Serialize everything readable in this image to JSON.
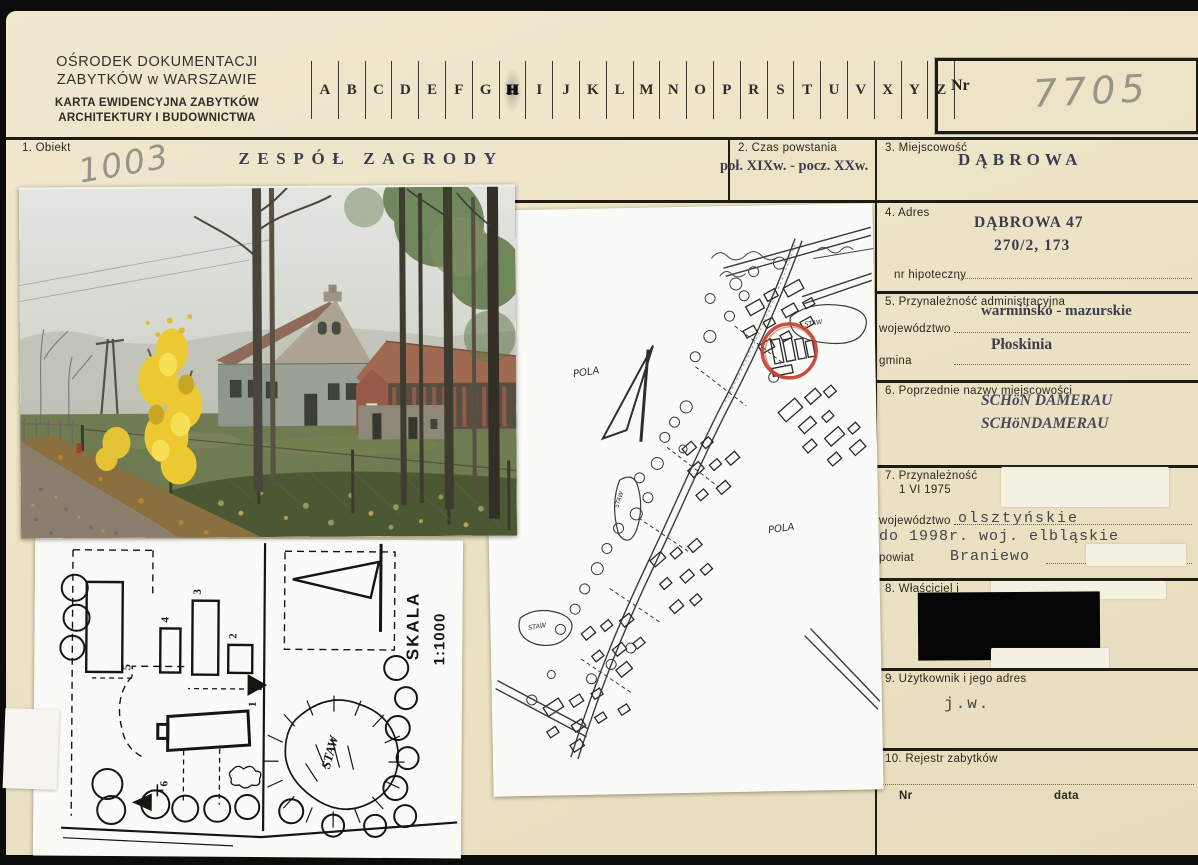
{
  "header": {
    "org_line1": "OŚRODEK DOKUMENTACJI",
    "org_line2": "ZABYTKÓW w WARSZAWIE",
    "card_type_line1": "KARTA EWIDENCYJNA ZABYTKÓW",
    "card_type_line2": "ARCHITEKTURY I BUDOWNICTWA",
    "nr_label": "Nr",
    "nr_value": "7705",
    "index_letters": [
      "A",
      "B",
      "C",
      "D",
      "E",
      "F",
      "G",
      "H",
      "I",
      "J",
      "K",
      "L",
      "M",
      "N",
      "O",
      "P",
      "R",
      "S",
      "T",
      "U",
      "V",
      "X",
      "Y",
      "Z"
    ],
    "index_marked_letter": "H"
  },
  "section1": {
    "label": "1.  Obiekt",
    "value": "ZESPÓŁ ZAGRODY",
    "inventory_number": "1003"
  },
  "section2": {
    "label": "2.  Czas powstania",
    "value": "poł. XIXw. - pocz. XXw."
  },
  "section3": {
    "label": "3.  Miejscowość",
    "value": "DĄBROWA"
  },
  "section4": {
    "label": "4.  Adres",
    "line1": "DĄBROWA 47",
    "line2": "270/2, 173",
    "field_label": "nr hipoteczny"
  },
  "section5": {
    "label": "5.  Przynależność administracyjna",
    "voivodeship_label": "województwo",
    "voivodeship_value": "warmińsko - mazurskie",
    "gmina_label": "gmina",
    "gmina_value": "Płoskinia"
  },
  "section6": {
    "label": "6.  Poprzednie nazwy miejscowości",
    "name1": "SCHöN DAMERAU",
    "name2": "SCHöNDAMERAU"
  },
  "section7": {
    "label": "7.  Przynależność",
    "date": "1 VI 1975",
    "voivodeship_label": "województwo",
    "voivodeship_value": "olsztyńskie",
    "note": "do 1998r. woj. elbląskie",
    "powiat_label": "powiat",
    "powiat_value": "Braniewo"
  },
  "section8": {
    "label": "8.  Właściciel i"
  },
  "section9": {
    "label": "9.  Użytkownik i jego adres",
    "value": "j.w."
  },
  "section10": {
    "label": "10.  Rejestr zabytków",
    "nr_label": "Nr",
    "data_label": "data"
  },
  "site_map": {
    "pola_label": "POLA",
    "staw_label": "STAW",
    "highlight_color": "#c33d2c"
  },
  "site_plan": {
    "scale_label": "SKALA",
    "scale_value": "1:1000",
    "staw_label": "STAW",
    "building_numbers": [
      "1",
      "2",
      "3",
      "4",
      "5",
      "6"
    ]
  }
}
